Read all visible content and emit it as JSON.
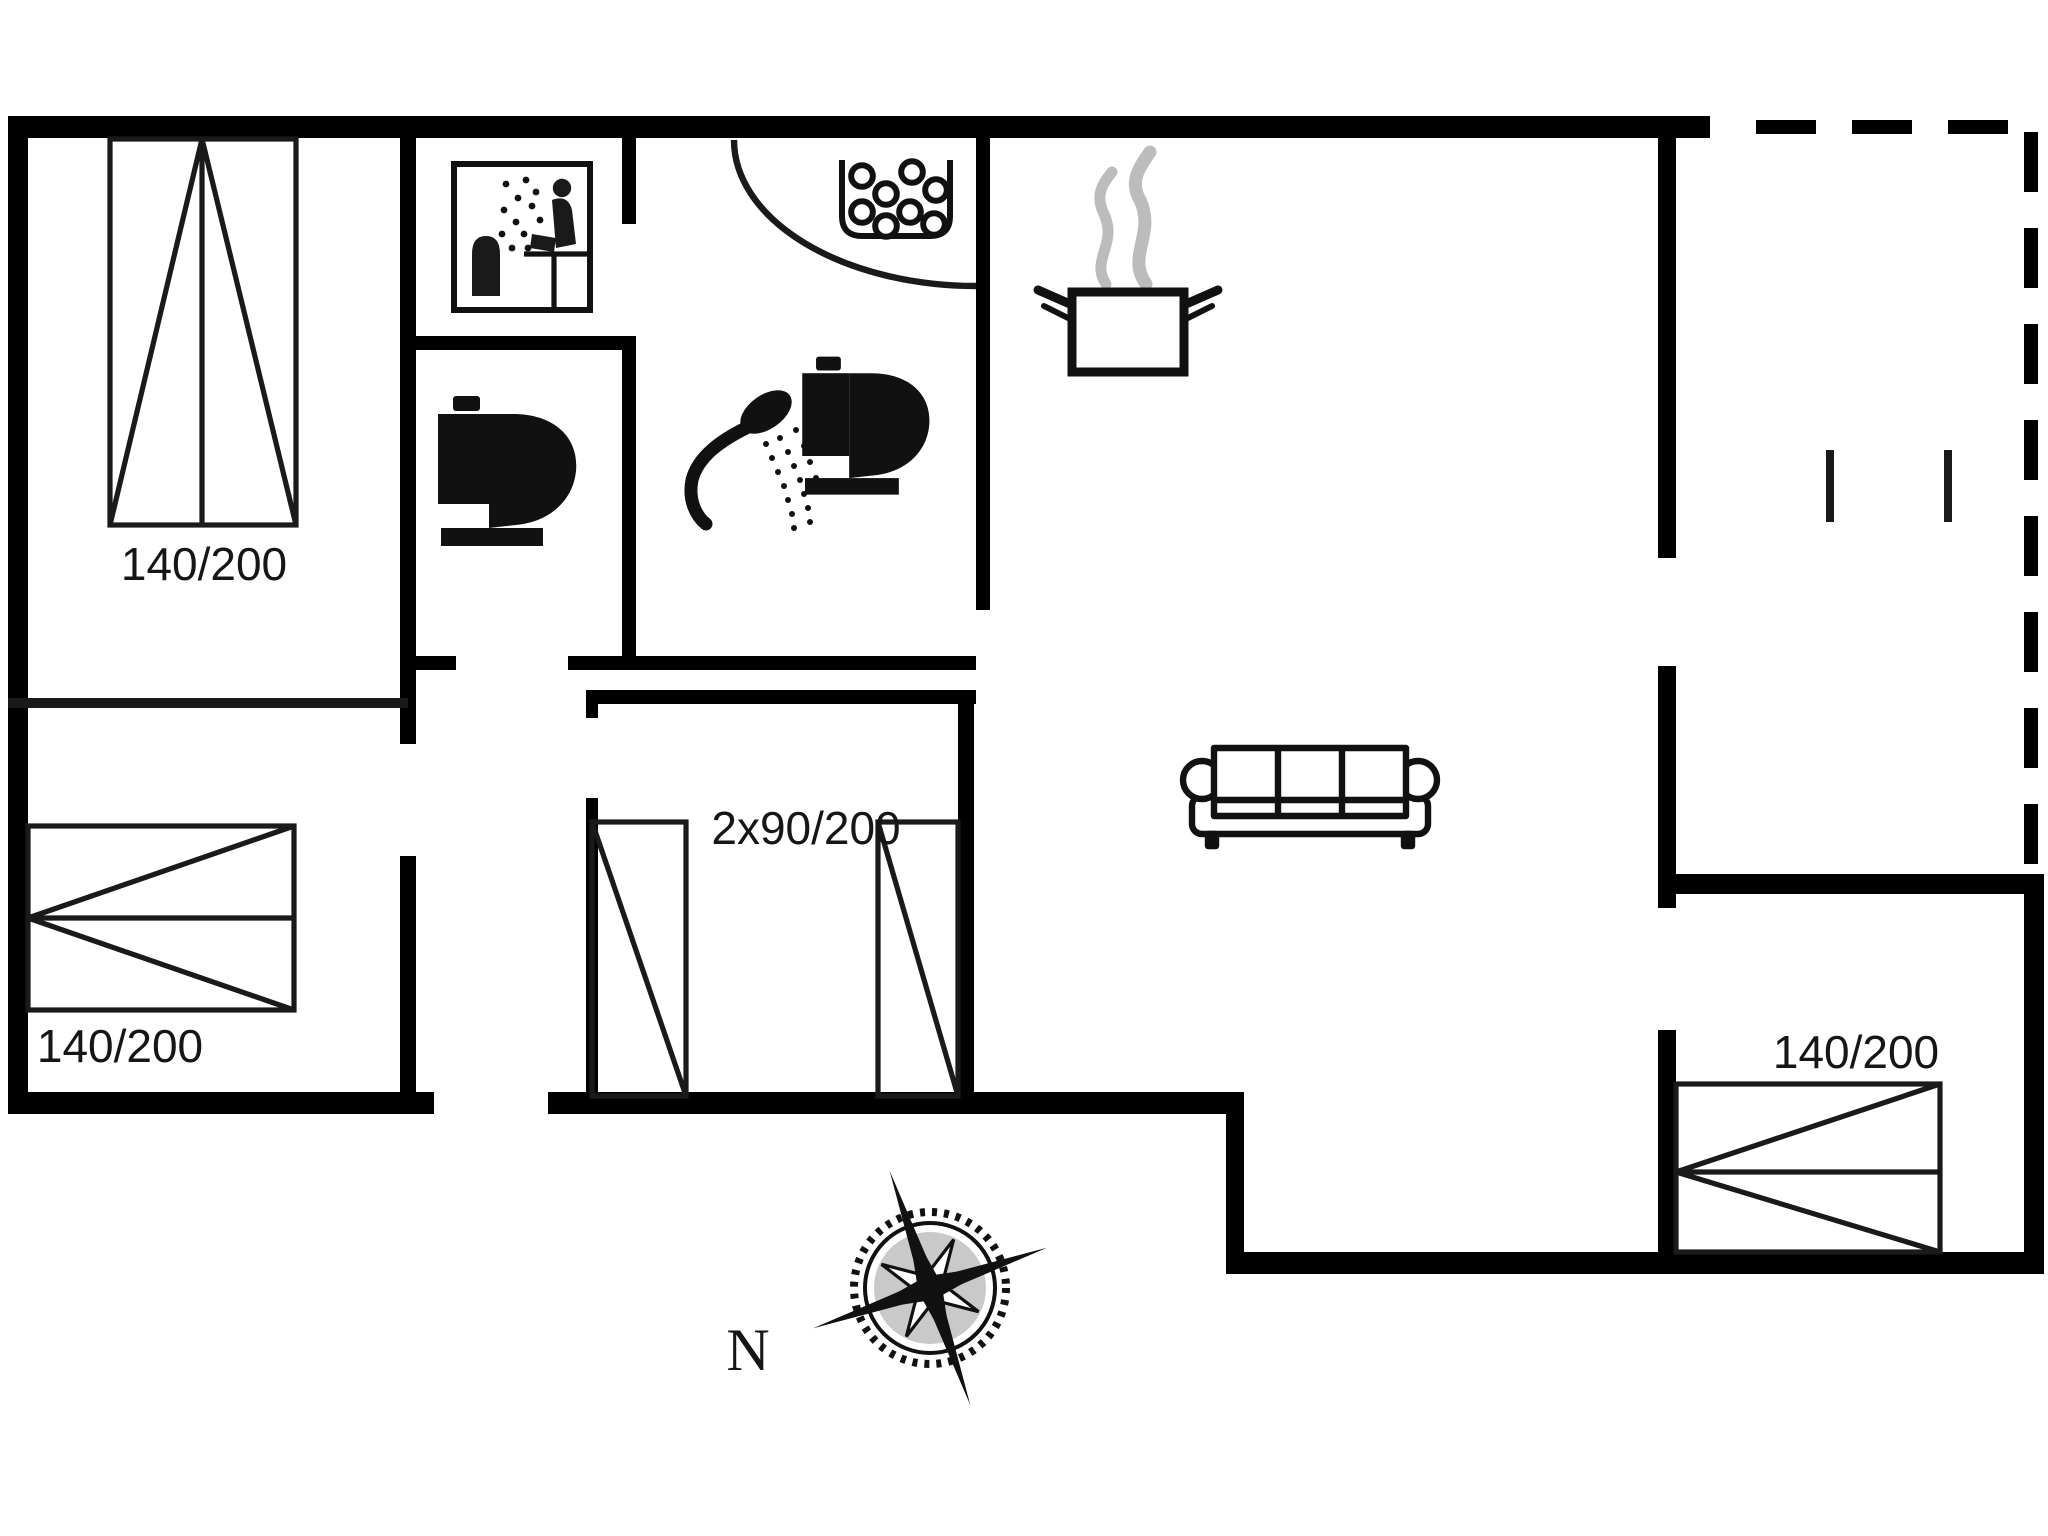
{
  "floor_plan": {
    "beds": [
      {
        "id": "bed-top-left",
        "label": "140/200"
      },
      {
        "id": "bed-mid-left",
        "label": "140/200"
      },
      {
        "id": "beds-middle-pair",
        "label": "2x90/200"
      },
      {
        "id": "bed-bottom-right",
        "label": "140/200"
      }
    ],
    "compass": {
      "north_label": "N"
    },
    "colors": {
      "wall": "#000000",
      "line": "#1a1a1a",
      "steam": "#bcbcbc",
      "compass_fill": "#c9c9c9",
      "background": "#ffffff"
    },
    "icons": [
      "sauna-icon",
      "toilet-icon",
      "shower-icon",
      "basin-bubbles-icon",
      "cooking-pot-icon",
      "sofa-icon",
      "compass-rose-icon",
      "carport-dashed-outline"
    ]
  }
}
